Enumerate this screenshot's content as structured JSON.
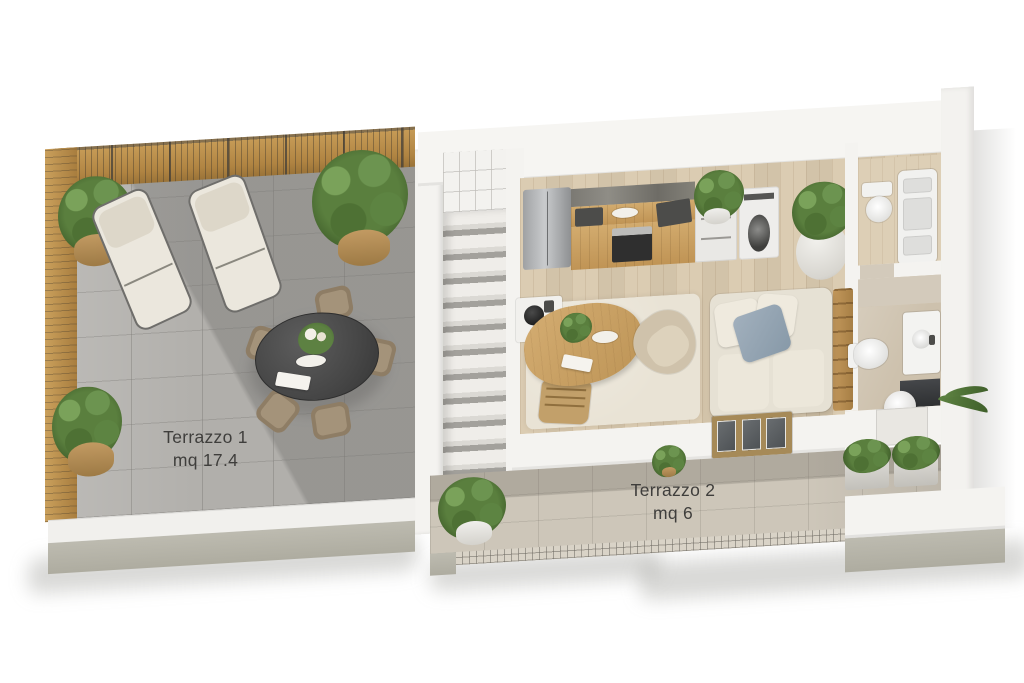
{
  "page": {
    "background": "#ffffff",
    "type": "3d-floorplan-render"
  },
  "terrace1": {
    "name": "Terrazzo 1",
    "area": "mq 17.4"
  },
  "terrace2": {
    "name": "Terrazzo 2",
    "area": "mq 6"
  },
  "palette": {
    "wall_white": "#f4f3f0",
    "terrace1_tile": "#b1afab",
    "fence_wood": "#c2964f",
    "interior_wood": "#d9c9ae",
    "terrace2_tile": "#cdc6b9",
    "concrete_base": "#b5b3a8",
    "sofa_cream": "#e6e1d4",
    "pillow_blue": "#93a2b2",
    "table_dark": "#464646",
    "plant_green": "#55763b",
    "label_text": "#3f3e3c"
  },
  "furniture": [
    "wood-fence",
    "lounge-chair",
    "outdoor-dining-table",
    "outdoor-chair",
    "potted-plant",
    "staircase",
    "refrigerator",
    "kitchen-cabinets",
    "oven",
    "drawer-unit",
    "washing-machine",
    "dining-table",
    "dining-chair",
    "armchair",
    "sofa",
    "rug",
    "ladder-shelf",
    "toilet",
    "shower-column",
    "vanity-sink",
    "washbasin",
    "sliding-door",
    "planter-box"
  ]
}
